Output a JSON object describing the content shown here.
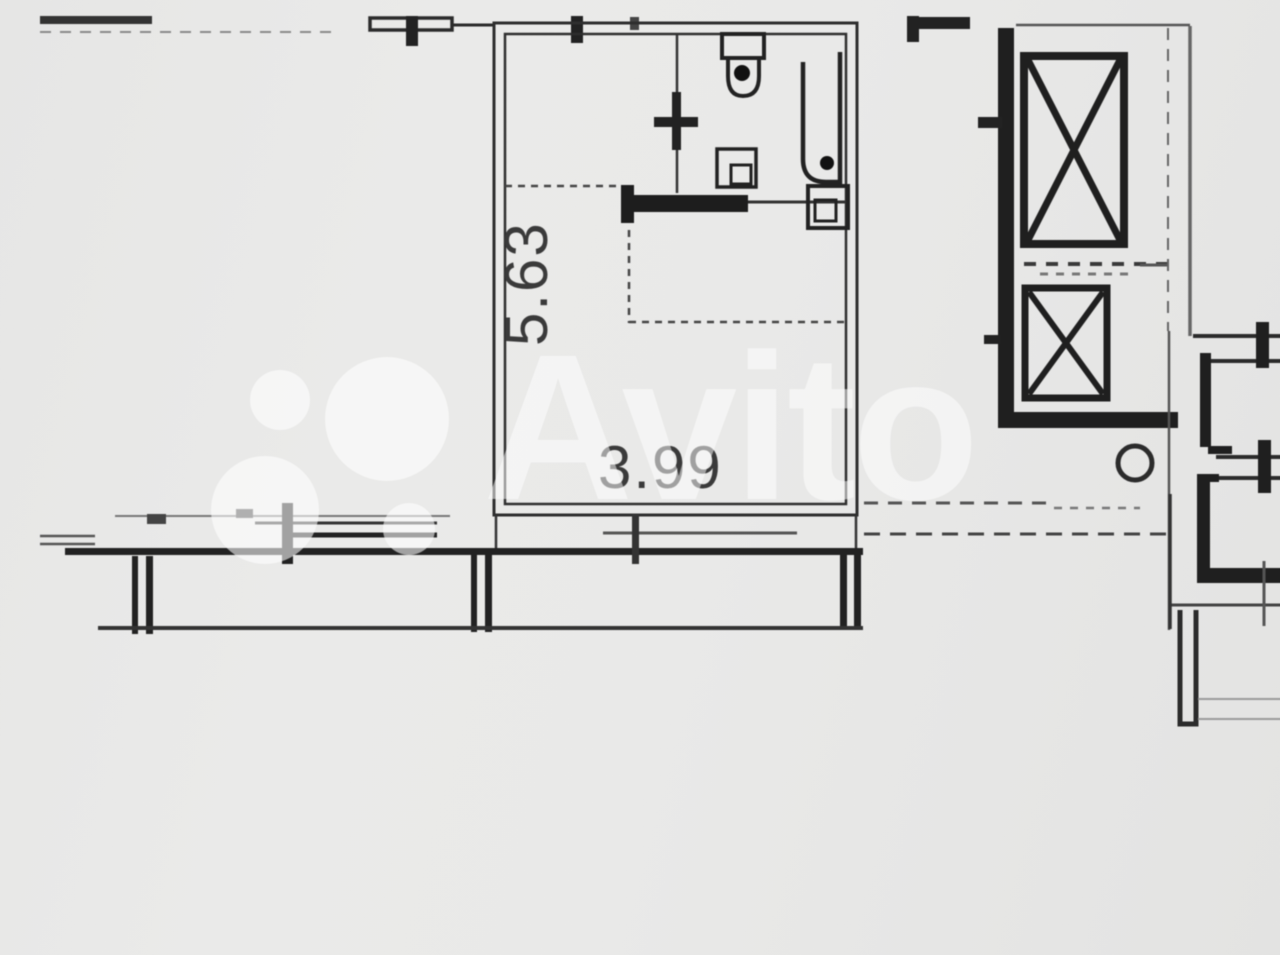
{
  "page": {
    "type": "floor-plan-photo",
    "width_px": 1280,
    "height_px": 939
  },
  "watermark": {
    "text": "Avito",
    "logo": "avito-four-circles-logo",
    "color": "#ffffff",
    "opacity": 0.52
  },
  "plan": {
    "dimension_labels": {
      "vertical": "5.63",
      "horizontal": "3.99"
    },
    "rooms": [
      {
        "name": "main-room",
        "width_m": "3.99",
        "height_m": "5.63"
      }
    ],
    "fixtures": [
      "toilet",
      "bathtub",
      "sink",
      "washing-machine",
      "counter"
    ],
    "features": [
      "elevator-shaft-large",
      "elevator-shaft-small",
      "window-top",
      "window-right-upper",
      "window-right-lower",
      "balcony",
      "stair-hall-walls"
    ],
    "colors": {
      "paper": "#e8e8e7",
      "ink": "#2b2b2b",
      "ink_faint": "#777777"
    }
  }
}
